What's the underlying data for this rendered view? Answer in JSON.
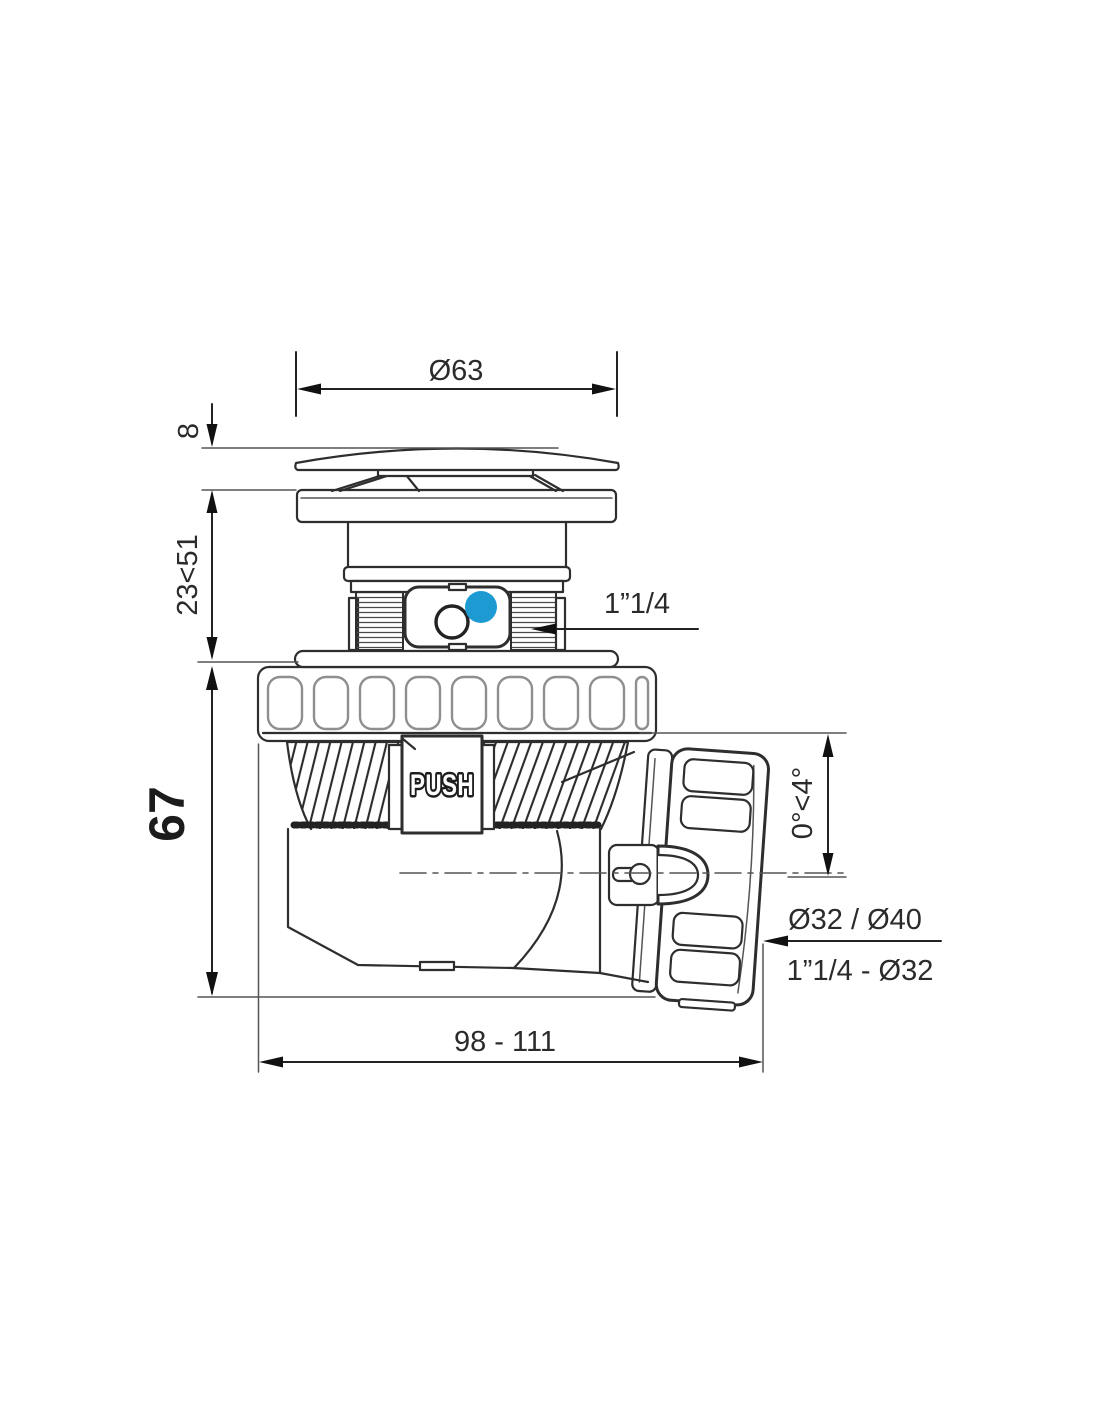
{
  "drawing": {
    "type": "technical-drawing",
    "subject": "push-operated bottle trap / drain waste with swivel outlet nut",
    "push_label": "PUSH"
  },
  "colors": {
    "line": "#2e2e2e",
    "accent_blue": "#1E9AD3"
  },
  "dimensions": {
    "cap_diameter": "Ø63",
    "cap_height": "8",
    "adjustable_height": "23<51",
    "body_height": "67",
    "inlet_thread": "1”1/4",
    "outlet_angle": "0°<4°",
    "outlet_sizes": "Ø32 / Ø40",
    "outlet_thread": "1”1/4 - Ø32",
    "overall_length": "98 - 111"
  }
}
